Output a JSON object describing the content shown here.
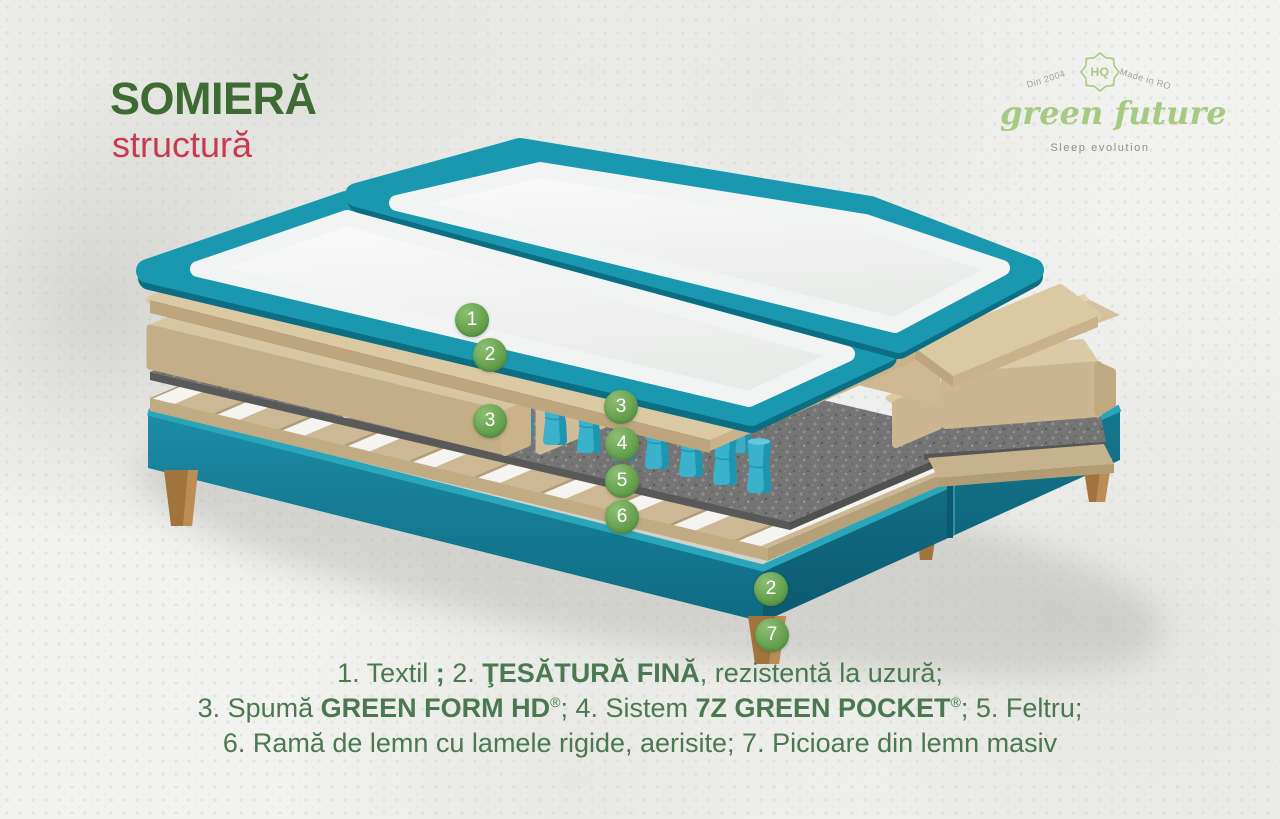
{
  "header": {
    "title": "SOMIERĂ",
    "subtitle": "structură"
  },
  "logo": {
    "arc_left": "Din 2004",
    "badge": "HQ",
    "arc_right": "Made in RO",
    "brand": "green future",
    "tagline": "Sleep evolution"
  },
  "markers": [
    {
      "label": "1"
    },
    {
      "label": "2"
    },
    {
      "label": "3"
    },
    {
      "label": "3"
    },
    {
      "label": "4"
    },
    {
      "label": "5"
    },
    {
      "label": "6"
    },
    {
      "label": "2"
    },
    {
      "label": "7"
    }
  ],
  "legend": {
    "lines": [
      {
        "segments": [
          {
            "t": "1. Textil ",
            "b": false
          },
          {
            "t": ";",
            "b": true
          },
          {
            "t": " 2. ",
            "b": false
          },
          {
            "t": "ŢESĂTURĂ FINĂ",
            "b": true
          },
          {
            "t": ", rezistentă la uzură;",
            "b": false
          }
        ]
      },
      {
        "segments": [
          {
            "t": "3. Spumă ",
            "b": false
          },
          {
            "t": "GREEN FORM HD",
            "b": true
          },
          {
            "t": "®",
            "b": false,
            "sup": true
          },
          {
            "t": "; 4. Sistem ",
            "b": false
          },
          {
            "t": "7Z GREEN POCKET",
            "b": true
          },
          {
            "t": "®",
            "b": false,
            "sup": true
          },
          {
            "t": "; 5. Feltru;",
            "b": false
          }
        ]
      },
      {
        "segments": [
          {
            "t": "6. Ramă de lemn cu lamele rigide, aerisite; 7. Picioare din lemn masiv",
            "b": false
          }
        ]
      }
    ]
  },
  "colors": {
    "accent_teal": "#1a98b0",
    "marker_green": "#649e4d",
    "title_green": "#3e6b33",
    "subtitle_red": "#c93a4e",
    "legend_green": "#4a7850",
    "logo_green": "#a6ca82",
    "foam_tan": "#d8c6a2",
    "spring_teal": "#3ab2cc",
    "felt_grey": "#757575",
    "wood_brown": "#a1743d"
  }
}
